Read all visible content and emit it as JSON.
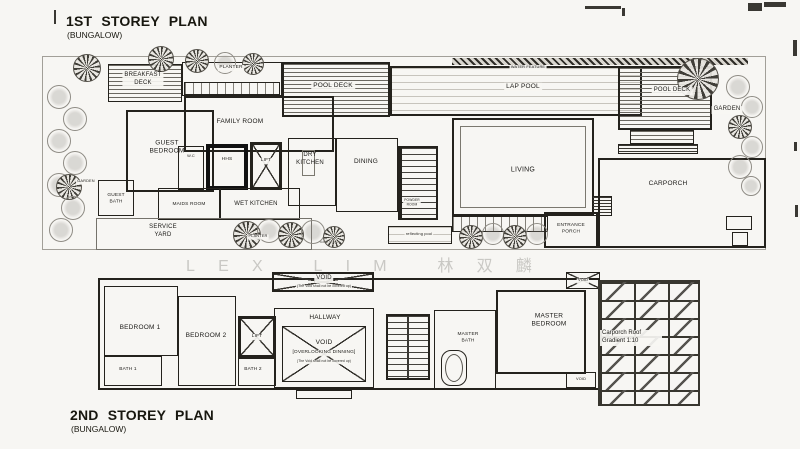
{
  "watermark": "LEX LIM 林双麟",
  "plan1": {
    "title": "1ST STOREY PLAN",
    "subtitle": "(BUNGALOW)",
    "rooms": {
      "breakfast_deck": "BREAKFAST\nDECK",
      "planter_top": "PLANTER",
      "pool_deck_left": "POOL DECK",
      "water_feature": "WATER FEATURE",
      "lap_pool": "LAP POOL",
      "pool_deck_right": "POOL DECK",
      "garden_right": "GARDEN",
      "garden_left": "GARDEN",
      "guest_bedroom": "GUEST\nBEDROOM",
      "family_room": "FAMILY ROOM",
      "wc": "W.C",
      "hhs": "HHS",
      "lift": "LIFT",
      "dry_kitchen": "DRY\nKITCHEN",
      "dining": "DINING",
      "powder_room": "POWDER\nROOM",
      "living": "LIVING",
      "guest_bath": "GUEST\nBATH",
      "maids_room": "MAIDS ROOM",
      "wet_kitchen": "WET KITCHEN",
      "service_yard": "SERVICE\nYARD",
      "planter_bottom": "PLANTER",
      "water_feature_small": "water feature",
      "reflecting_pool": "reflecting pool",
      "entrance_porch": "ENTRANCE\nPORCH",
      "carporch": "CARPORCH"
    }
  },
  "plan2": {
    "title": "2ND STOREY PLAN",
    "subtitle": "(BUNGALOW)",
    "rooms": {
      "bedroom1": "BEDROOM 1",
      "bedroom2": "BEDROOM 2",
      "bath1": "BATH 1",
      "bath2": "BATH 2",
      "lift": "LIFT",
      "hallway": "HALLWAY",
      "void_top": "VOID",
      "void_top_note": "(The Void shall not be covered up)",
      "void_main": "VOID",
      "void_main_sub": "[OVERLOOKING DINNING]",
      "void_main_note": "(The Void shall not be covered up)",
      "master_bath": "MASTER\nBATH",
      "master_bedroom": "MASTER\nBEDROOM",
      "void_tr": "VOID",
      "void_br": "VOID",
      "carporch_roof": "Carporch Roof\nGradient  1:10"
    }
  }
}
